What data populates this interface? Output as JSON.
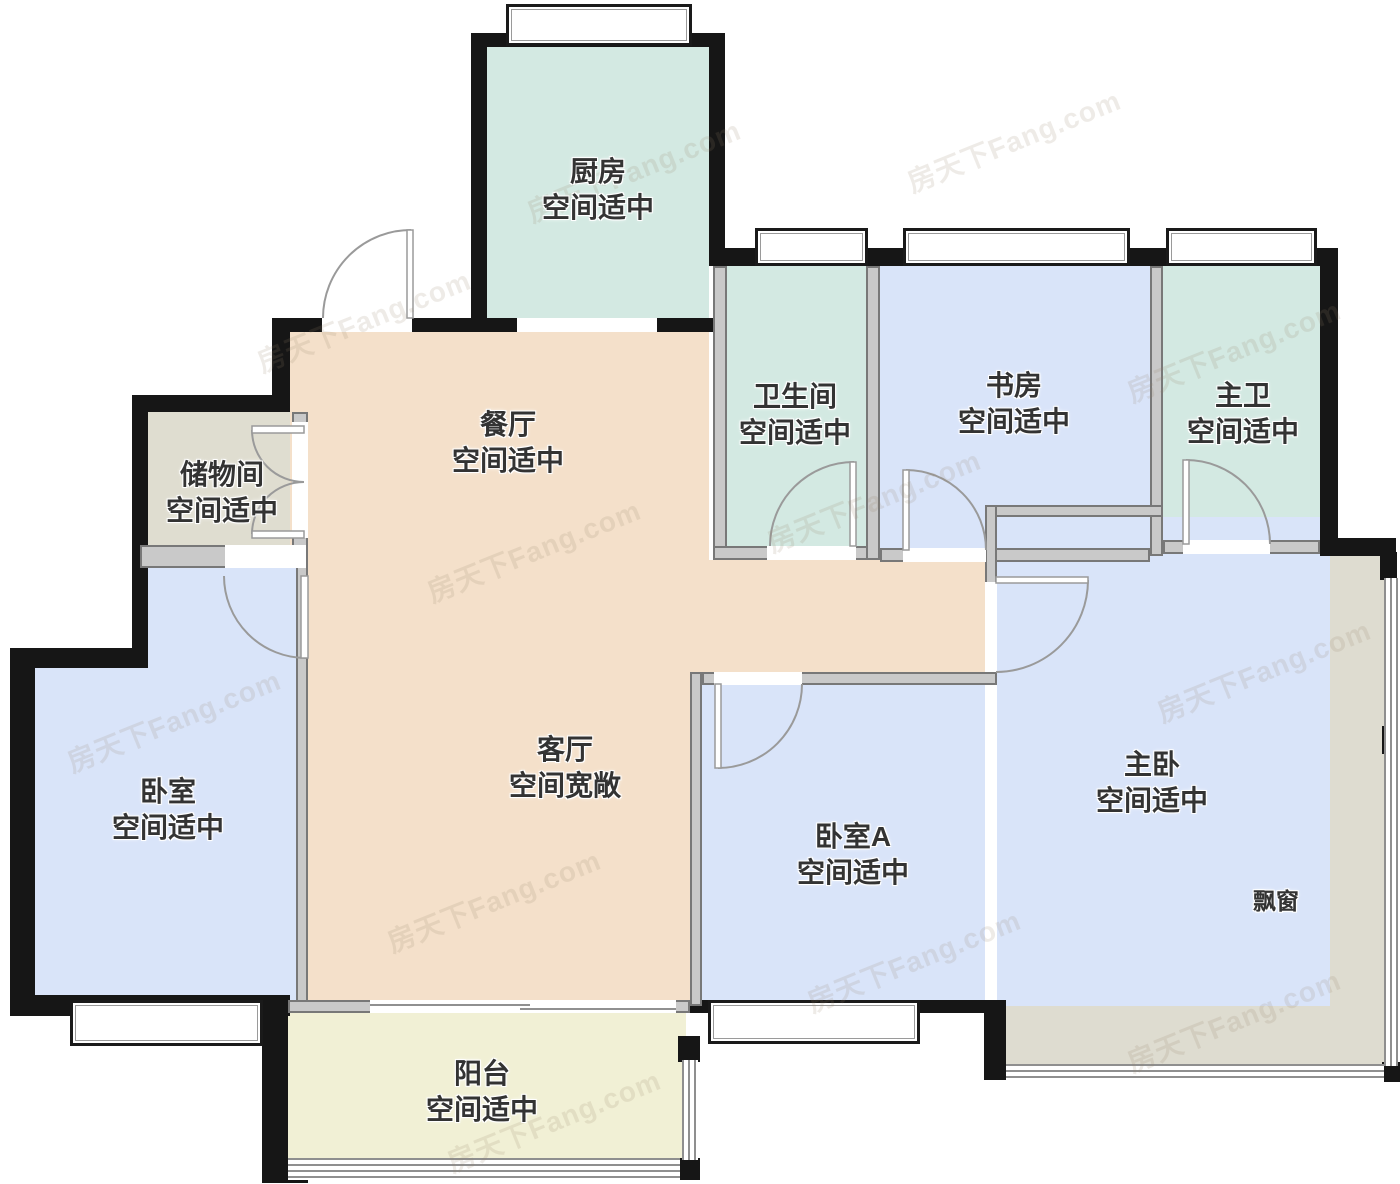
{
  "floorplan": {
    "watermark": "房天下Fang.com",
    "rooms": [
      {
        "id": "kitchen",
        "name": "厨房",
        "note": "空间适中"
      },
      {
        "id": "bathroom",
        "name": "卫生间",
        "note": "空间适中"
      },
      {
        "id": "study",
        "name": "书房",
        "note": "空间适中"
      },
      {
        "id": "master-bath",
        "name": "主卫",
        "note": "空间适中"
      },
      {
        "id": "storage",
        "name": "储物间",
        "note": "空间适中"
      },
      {
        "id": "dining",
        "name": "餐厅",
        "note": "空间适中"
      },
      {
        "id": "bedroom",
        "name": "卧室",
        "note": "空间适中"
      },
      {
        "id": "living",
        "name": "客厅",
        "note": "空间宽敞"
      },
      {
        "id": "bedroom-a",
        "name": "卧室A",
        "note": "空间适中"
      },
      {
        "id": "master-bedroom",
        "name": "主卧",
        "note": "空间适中"
      },
      {
        "id": "balcony",
        "name": "阳台",
        "note": "空间适中"
      }
    ],
    "annotations": [
      {
        "id": "bay-window",
        "label": "飘窗"
      }
    ],
    "colors": {
      "teal": "#d3e9e2",
      "blue": "#d9e4f9",
      "peach": "#f4e0ca",
      "storage": "#dfddd0",
      "balcony": "#f1f0d5",
      "bay": "#dedcd0",
      "wall_dark": "#161616",
      "wall_gray": "#c9c9c9",
      "label": "#333333"
    }
  }
}
